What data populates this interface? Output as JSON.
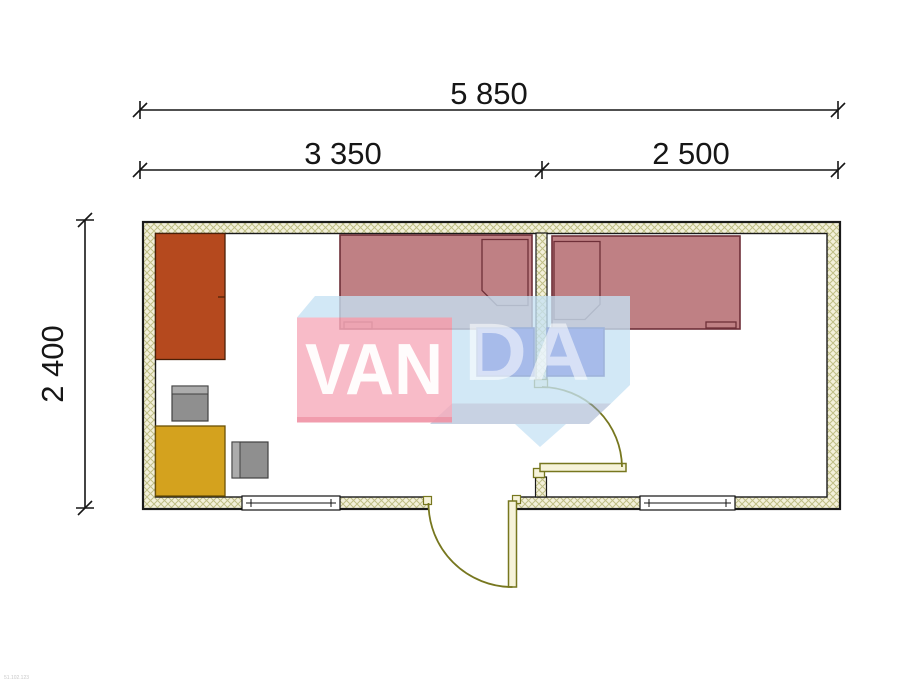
{
  "drawing": {
    "type": "floor-plan",
    "dimensions": {
      "overall_width": {
        "label": "5 850"
      },
      "left_room_width": {
        "label": "3 350"
      },
      "right_room_width": {
        "label": "2 500"
      },
      "overall_height": {
        "label": "2 400"
      }
    },
    "watermark": {
      "front_text": "VAN",
      "side_text": "DA"
    },
    "footer_code": "51.102.123",
    "colors": {
      "background": "#FFFFFF",
      "wall_fill": "#F3F0DA",
      "wall_hatch": "#9C9C4E",
      "outline": "#1A1A1A",
      "wardrobe": "#B5491E",
      "wardrobe_outline": "#4A1F07",
      "table": "#D4A21E",
      "table_outline": "#6B5106",
      "chair": "#8F8F8F",
      "chair_back": "#ACACAC",
      "chair_outline": "#404040",
      "bed": "#BF8084",
      "bed_outline": "#6E2F38",
      "nightstand": "#3C35C8",
      "nightstand_outline": "#191280",
      "door": "#77771F",
      "door_leaf_fill": "#F6F3D9",
      "dimension": "#161616",
      "watermark_pink": "#F7ACBC",
      "watermark_blue": "#C5E1F4",
      "watermark_shadow": "#92A6C7"
    }
  }
}
